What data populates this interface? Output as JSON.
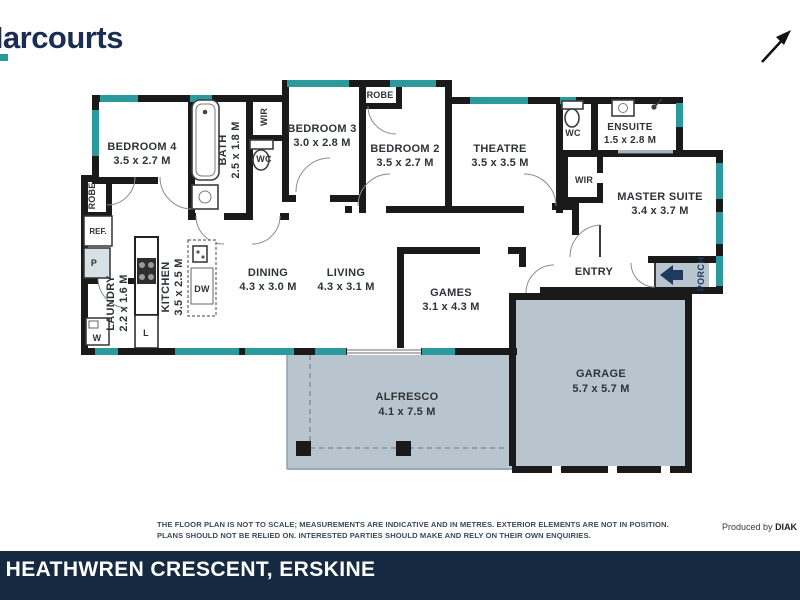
{
  "brand": {
    "logo_text": "Harcourts"
  },
  "plan": {
    "rooms": {
      "bedroom4": {
        "name": "BEDROOM 4",
        "dims": "3.5 x 2.7 M"
      },
      "bedroom3": {
        "name": "BEDROOM 3",
        "dims": "3.0 x 2.8 M"
      },
      "bedroom2": {
        "name": "BEDROOM 2",
        "dims": "3.5 x 2.7 M"
      },
      "theatre": {
        "name": "THEATRE",
        "dims": "3.5 x 3.5 M"
      },
      "ensuite": {
        "name": "ENSUITE",
        "dims": "1.5 x 2.8 M"
      },
      "master": {
        "name": "MASTER SUITE",
        "dims": "3.4 x 3.7 M"
      },
      "dining": {
        "name": "DINING",
        "dims": "4.3 x 3.0 M"
      },
      "living": {
        "name": "LIVING",
        "dims": "4.3 x 3.1 M"
      },
      "games": {
        "name": "GAMES",
        "dims": "3.1 x 4.3 M"
      },
      "kitchen": {
        "name": "KITCHEN",
        "dims": "3.5 x 2.5 M"
      },
      "laundry": {
        "name": "LAUNDRY",
        "dims": "2.2 x 1.6 M"
      },
      "bath": {
        "name": "BATH",
        "dims": "2.5 x 1.8 M"
      },
      "garage": {
        "name": "GARAGE",
        "dims": "5.7 x 5.7 M"
      },
      "alfresco": {
        "name": "ALFRESCO",
        "dims": "4.1 x 7.5 M"
      }
    },
    "labels": {
      "wir_front": "WIR",
      "wc_front": "WC",
      "robe_hall": "ROBE",
      "robe_bed": "ROBE",
      "wc_ensuite": "WC",
      "wir_master": "WIR",
      "fridge": "REF.",
      "pantry": "P",
      "washer": "W",
      "linen": "L",
      "dishwasher": "DW",
      "entry": "ENTRY",
      "porch": "PORCH"
    },
    "colors": {
      "window_teal": "#2a9a9c",
      "wall_black": "#1a1a1a",
      "outdoor_fill": "#b8c5ce",
      "porch_arrow_navy": "#1e3a5f"
    }
  },
  "footer": {
    "disclaimer_line1": "THE FLOOR PLAN IS NOT TO SCALE; MEASUREMENTS ARE INDICATIVE AND IN METRES. EXTERIOR ELEMENTS ARE NOT IN POSITION.",
    "disclaimer_line2": "PLANS SHOULD NOT BE RELIED ON. INTERESTED PARTIES SHOULD MAKE AND RELY ON THEIR OWN ENQUIRIES.",
    "produced_by_prefix": "Produced by",
    "produced_by_brand": "DIAK"
  },
  "address_bar": {
    "partial_prefix": "-",
    "text": "HEATHWREN CRESCENT, ERSKINE"
  }
}
